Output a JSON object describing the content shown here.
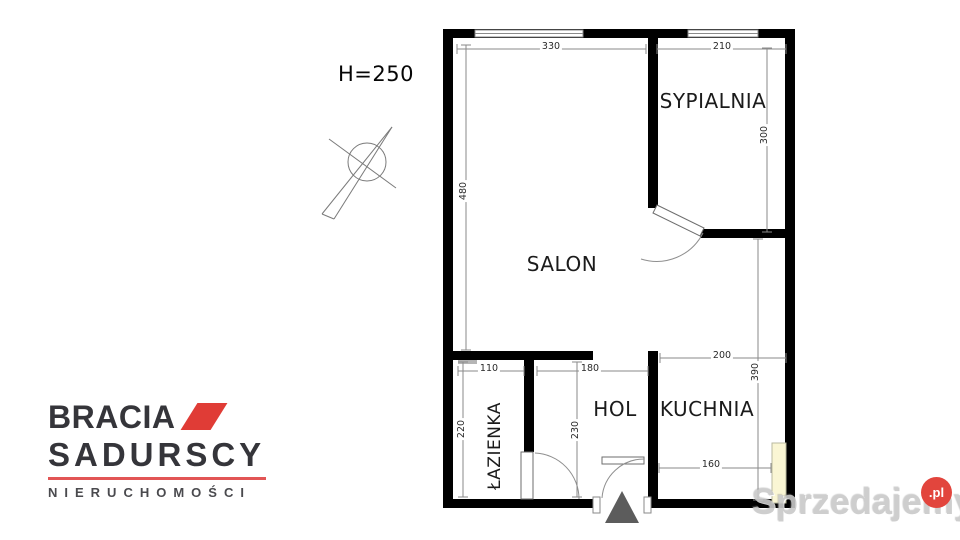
{
  "plan": {
    "ceiling_height": "H=250"
  },
  "rooms": {
    "salon": {
      "label": "SALON"
    },
    "sypialnia": {
      "label": "SYPIALNIA"
    },
    "kuchnia": {
      "label": "KUCHNIA"
    },
    "hol": {
      "label": "HOL"
    },
    "lazienka": {
      "label": "ŁAZIENKA"
    }
  },
  "dimensions_cm": {
    "salon_width": "330",
    "salon_depth": "480",
    "sypialnia_width": "210",
    "sypialnia_depth": "300",
    "lazienka_width": "110",
    "lazienka_depth": "220",
    "hol_width": "180",
    "hol_depth": "230",
    "kuchnia_width": "200",
    "kuchnia_depth": "390",
    "kuchnia_lower_width": "160"
  },
  "logo": {
    "brand_word1": "BRACIA",
    "brand_word2": "SADURSCY",
    "tagline": "NIERUCHOMOŚCI"
  },
  "watermark": {
    "site": "Sprzedajemy",
    "tld": ".pl"
  },
  "colors": {
    "wall": "#000000",
    "dim_line": "#8a8a8a",
    "text": "#1b1b1b",
    "logo_dark": "#35353a",
    "logo_red": "#e03c36",
    "logo_underline": "#e25555",
    "tagline_gray": "#4a4a4e",
    "watermark_gray": "#c9c9c9",
    "watermark_red": "#e2453d",
    "highlight_yellow": "#faf6d4",
    "entrance_triangle": "#5c5c5c"
  }
}
